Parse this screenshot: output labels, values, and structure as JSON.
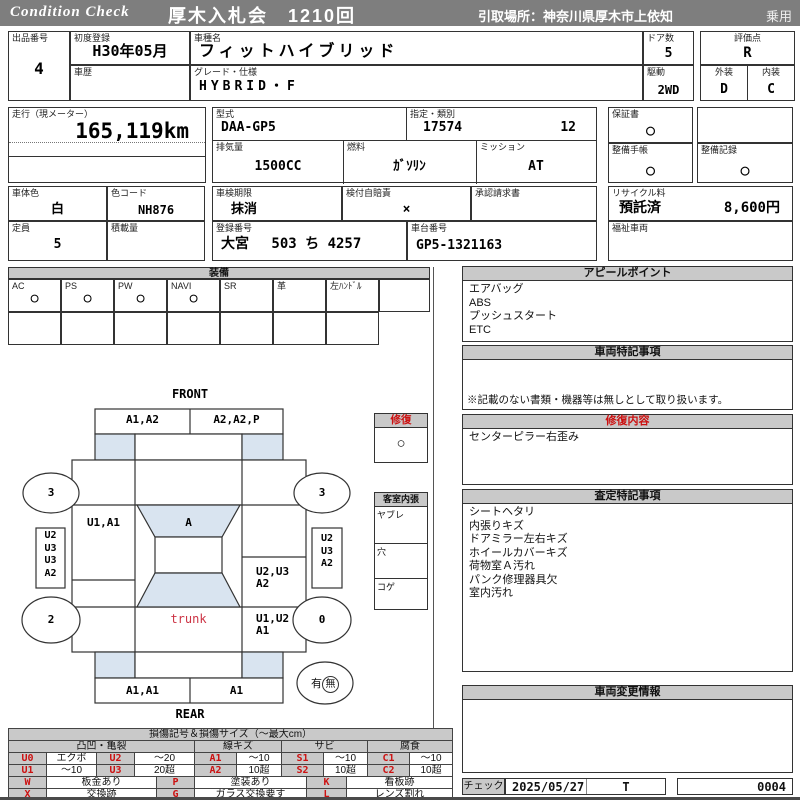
{
  "header": {
    "brand": "Condition  Check",
    "auction_title": "厚木入札会　1210回",
    "pickup": "引取場所：神奈川県厚木市上依知",
    "category": "乗用"
  },
  "info": {
    "lot": {
      "label": "出品番号",
      "value": "4"
    },
    "first_reg": {
      "label": "初度登録",
      "value": "H30年05月"
    },
    "history": {
      "label": "車歴",
      "value": ""
    },
    "model": {
      "label": "車種名",
      "value": "フィットハイブリッド"
    },
    "grade": {
      "label": "グレード・仕様",
      "value": "HYBRID・F"
    },
    "doors": {
      "label": "ドア数",
      "value": "5"
    },
    "drive": {
      "label": "駆動",
      "value": "2WD"
    },
    "score": {
      "label": "評価点",
      "value": "R"
    },
    "exterior": {
      "label": "外装",
      "value": "D"
    },
    "interior": {
      "label": "内装",
      "value": "C"
    },
    "mileage": {
      "label": "走行（現メーター）",
      "value": "165,119km"
    },
    "model_code": {
      "label": "型式",
      "value": "DAA-GP5"
    },
    "designation": {
      "label": "指定・類別",
      "value1": "17574",
      "value2": "12"
    },
    "warranty": {
      "label": "保証書",
      "value": "○"
    },
    "displacement": {
      "label": "排気量",
      "value": "1500CC"
    },
    "fuel": {
      "label": "燃料",
      "value": "ｶﾞｿﾘﾝ"
    },
    "mission": {
      "label": "ミッション",
      "value": "AT"
    },
    "maint_book": {
      "label": "整備手帳",
      "value": "○"
    },
    "maint_record": {
      "label": "整備記録",
      "value": "○"
    },
    "body_color": {
      "label": "車体色",
      "value": "白"
    },
    "color_code": {
      "label": "色コード",
      "value": "NH876"
    },
    "inspection": {
      "label": "車検期限",
      "value": "抹消"
    },
    "insurance": {
      "label": "検付自賠責",
      "value": "×"
    },
    "approval": {
      "label": "承認請求書",
      "value": ""
    },
    "recycle": {
      "label": "リサイクル料",
      "status": "預託済",
      "fee": "8,600円"
    },
    "capacity": {
      "label": "定員",
      "value": "5"
    },
    "payload": {
      "label": "積載量",
      "value": ""
    },
    "reg_no": {
      "label": "登録番号",
      "value": "大宮　 503 ち 4257"
    },
    "chassis": {
      "label": "車台番号",
      "value": "GP5-1321163"
    },
    "welfare": {
      "label": "福祉車両",
      "value": ""
    }
  },
  "equipment": {
    "title": "装備",
    "items": [
      {
        "label": "AC",
        "value": "○"
      },
      {
        "label": "PS",
        "value": "○"
      },
      {
        "label": "PW",
        "value": "○"
      },
      {
        "label": "NAVI",
        "value": "○"
      },
      {
        "label": "SR",
        "value": ""
      },
      {
        "label": "革",
        "value": ""
      },
      {
        "label": "左ﾊﾝﾄﾞﾙ",
        "value": ""
      },
      {
        "label": "",
        "value": ""
      }
    ]
  },
  "diagram": {
    "front_label": "FRONT",
    "rear_label": "REAR",
    "front_bumper_left": "A1,A2",
    "front_bumper_right": "A2,A2,P",
    "wheel_front_left": "3",
    "wheel_front_right": "3",
    "wheel_rear_left": "2",
    "wheel_rear_right": "0",
    "left_rocker": "U2\nU3\nU3\nA2",
    "right_rocker": "U2\nU3\nA2",
    "front_door_left": "U1,A1",
    "windshield": "A",
    "right_quarter": "U2,U3\nA2",
    "trunk_label": "trunk",
    "rear_right": "U1,U2\nA1",
    "rear_bumper_left": "A1,A1",
    "rear_bumper_right": "A1",
    "spare_yes": "有",
    "spare_no": "無",
    "repair_box_title": "修復",
    "repair_box_value": "○",
    "cabin_box_title": "客室内張",
    "cabin_rows": [
      "ヤブレ",
      "穴",
      "コゲ"
    ]
  },
  "panels": {
    "appeal_title": "アピールポイント",
    "appeal_lines": "エアバッグ\nABS\nプッシュスタート\nETC",
    "vehicle_notes_title": "車両特記事項",
    "vehicle_notes_footer": "※記載のない書類・機器等は無しとして取り扱います。",
    "repair_title": "修復内容",
    "repair_lines": "センターピラー右歪み",
    "assessment_title": "査定特記事項",
    "assessment_lines": "シートヘタリ\n内張りキズ\nドアミラー左右キズ\nホイールカバーキズ\n荷物室Ａ汚れ\nパンク修理器具欠\n室内汚れ",
    "change_title": "車両変更情報"
  },
  "legend": {
    "title": "損傷記号＆損傷サイズ（～最大cm）",
    "groups": [
      "凸凹・亀裂",
      "線キズ",
      "サビ",
      "腐食"
    ],
    "rows": [
      [
        "U0",
        "エクボ",
        "U2",
        "～20",
        "A1",
        "～10",
        "S1",
        "～10",
        "C1",
        "～10"
      ],
      [
        "U1",
        "～10",
        "U3",
        "20超",
        "A2",
        "10超",
        "S2",
        "10超",
        "C2",
        "10超"
      ]
    ],
    "rows2": [
      [
        "W",
        "板金あり",
        "P",
        "塗装あり",
        "K",
        "看板跡"
      ],
      [
        "X",
        "交換跡",
        "G",
        "ガラス交換要す",
        "L",
        "レンズ割れ"
      ]
    ]
  },
  "footer": {
    "check_label": "チェック",
    "date": "2025/05/27",
    "inspector": "T",
    "serial": "0004"
  }
}
